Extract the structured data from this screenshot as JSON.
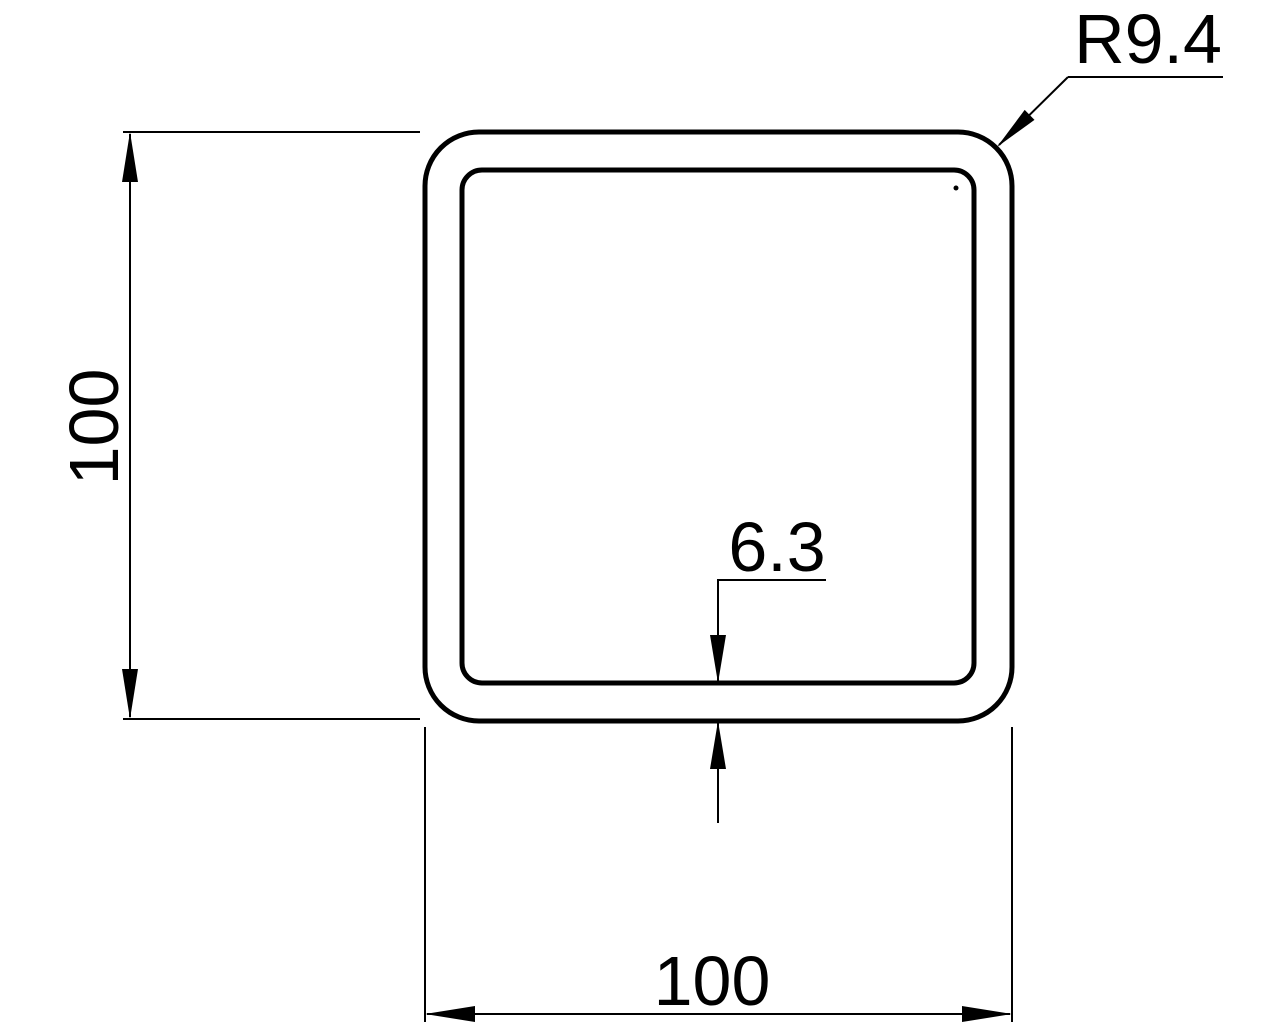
{
  "drawing": {
    "labels": {
      "height_dim": "100",
      "width_dim": "100",
      "wall_thickness_dim": "6.3",
      "corner_radius_dim": "R9.4"
    },
    "colors": {
      "line": "#000000",
      "background": "#ffffff"
    }
  }
}
